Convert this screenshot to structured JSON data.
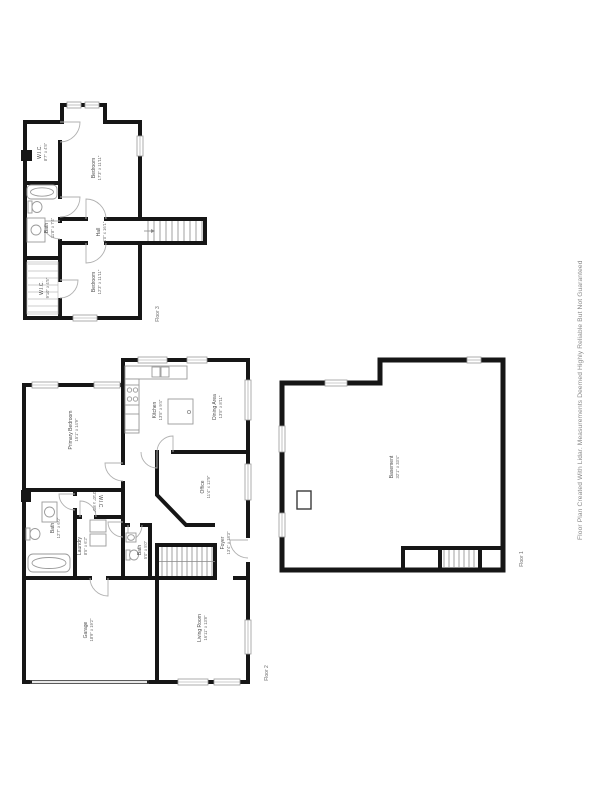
{
  "page": {
    "disclaimer": "Floor Plan Created With Lidar. Measurements Deemed Highly Reliable But Not Guaranteed"
  },
  "colors": {
    "wall": "#161616",
    "room_text": "#4d4d4d",
    "dim_text": "#6a6a6a",
    "fixture_stroke": "#9a9a9a",
    "disclaimer_text": "#8a8a8a",
    "background": "#ffffff"
  },
  "floors": {
    "floor3": {
      "label": "Floor 3",
      "rooms": {
        "wic_top": {
          "name": "W.I.C.",
          "dims": "8'7\" x 4'5\""
        },
        "bedroom_top": {
          "name": "Bedroom",
          "dims": "17'3\" x 11'11\""
        },
        "bath": {
          "name": "Bath",
          "dims": "11'8\" x 7'4\""
        },
        "hall": {
          "name": "Hall",
          "dims": "4'0\" x 16'1\""
        },
        "bedroom_bottom": {
          "name": "Bedroom",
          "dims": "12'3\" x 11'11\""
        },
        "wic_bottom": {
          "name": "W.I.C.",
          "dims": "9'10\" x 4'5\""
        }
      }
    },
    "floor2": {
      "label": "Floor 2",
      "rooms": {
        "primary_bedroom": {
          "name": "Primary Bedroom",
          "dims": "15'1\" x 14'9\""
        },
        "kitchen": {
          "name": "Kitchen",
          "dims": "13'5\" x 9'4\""
        },
        "dining": {
          "name": "Dining Area",
          "dims": "13'5\" x 8'11\""
        },
        "office": {
          "name": "Office",
          "dims": "11'4\" x 12'9\""
        },
        "wic": {
          "name": "W.I.C.",
          "dims": "3'10\" x 8'0\""
        },
        "bath": {
          "name": "Bath",
          "dims": "12'7\" x 6'0\""
        },
        "laundry": {
          "name": "Laundry",
          "dims": "8'5\" x 6'2\""
        },
        "bath_small": {
          "name": "Bath",
          "dims": "5'0\" x 5'0\""
        },
        "foyer": {
          "name": "Foyer",
          "dims": "13'4\" x 18'3\""
        },
        "garage": {
          "name": "Garage",
          "dims": "18'9\" x 19'2\""
        },
        "living_room": {
          "name": "Living Room",
          "dims": "16'11\" x 13'8\""
        }
      }
    },
    "floor1": {
      "label": "Floor 1",
      "rooms": {
        "basement": {
          "name": "Basement",
          "dims": "32'1\" x 33'4\""
        }
      }
    }
  }
}
